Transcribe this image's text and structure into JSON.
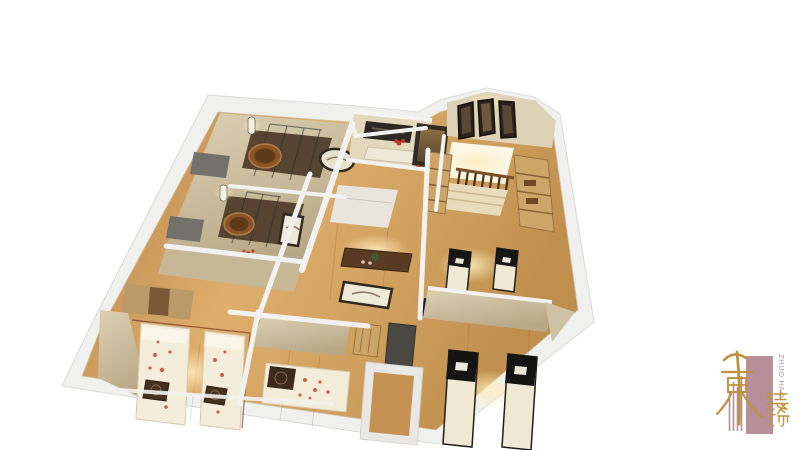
{
  "canvas": {
    "width": 800,
    "height": 450,
    "background_color": "#ffffff"
  },
  "scene": {
    "type": "3d-floorplan-render",
    "description": "Bird's-eye 3D cutaway render of a spa / massage center interior with bath rooms, massage rooms, bedrooms, reception and staircase",
    "palette": {
      "outer_wall": "#f0f0ee",
      "wood_floor_dark": "#b58148",
      "wood_floor_light": "#e2b172",
      "wall_beige": "#d5c9ac",
      "bath_floor_dark": "#564430",
      "tub_wood": "#8c5426",
      "bedding_cream": "#f3ecd8",
      "floral_accent": "#c4604a",
      "massage_table_black": "#161614",
      "furniture_dark_brown": "#46301e",
      "warm_glow": "#ffedbe",
      "locker_wood": "#cda569"
    }
  },
  "logo": {
    "brand_vertical_text": "ZHUO HAO",
    "chinese_characters": "装饰",
    "calligraphy_mark": "卓昊",
    "colors": {
      "mauve": "#b58d96",
      "gold": "#bf9240"
    }
  }
}
